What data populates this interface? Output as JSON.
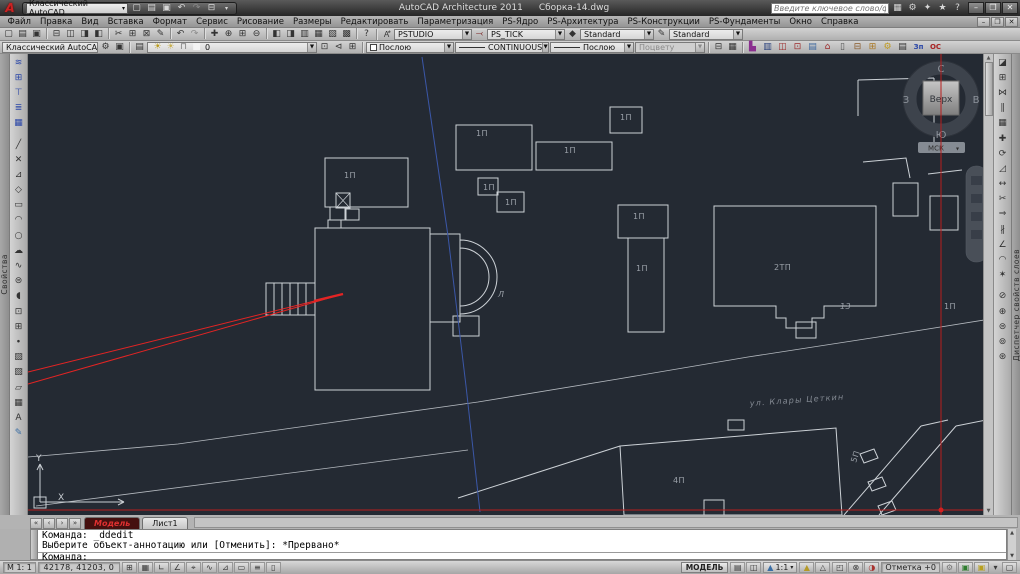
{
  "window": {
    "app_title": "AutoCAD Architecture 2011",
    "doc_title": "Сборка-14.dwg",
    "workspace": "Классический AutoCAD",
    "search_placeholder": "Введите ключевое слово/фразу",
    "minimize": "–",
    "restore": "❐",
    "close": "✕"
  },
  "menu": {
    "items": [
      "Файл",
      "Правка",
      "Вид",
      "Вставка",
      "Формат",
      "Сервис",
      "Рисование",
      "Размеры",
      "Редактировать",
      "Параметризация",
      "PS-Ядро",
      "PS-Архитектура",
      "PS-Конструкции",
      "PS-Фундаменты",
      "Окно",
      "Справка"
    ]
  },
  "toolbar1": {
    "icons": [
      {
        "n": "new-file-icon",
        "g": "▢"
      },
      {
        "n": "open-file-icon",
        "g": "▤"
      },
      {
        "n": "save-icon",
        "g": "▣"
      },
      {
        "n": "sep",
        "g": ""
      },
      {
        "n": "plot-icon",
        "g": "⊟"
      },
      {
        "n": "plot-preview-icon",
        "g": "◫"
      },
      {
        "n": "publish-icon",
        "g": "◨"
      },
      {
        "n": "3ddwf-icon",
        "g": "◧"
      },
      {
        "n": "sep",
        "g": ""
      },
      {
        "n": "cut-icon",
        "g": "✂"
      },
      {
        "n": "copy-clip-icon",
        "g": "⊞"
      },
      {
        "n": "paste-icon",
        "g": "⊠"
      },
      {
        "n": "match-properties-icon",
        "g": "✎"
      },
      {
        "n": "sep",
        "g": ""
      },
      {
        "n": "undo-icon",
        "g": "↶"
      },
      {
        "n": "redo-icon",
        "g": "↷",
        "c": "#8a8a8a"
      },
      {
        "n": "sep",
        "g": ""
      },
      {
        "n": "pan-icon",
        "g": "✚"
      },
      {
        "n": "zoom-realtime-icon",
        "g": "⊕"
      },
      {
        "n": "zoom-window-icon",
        "g": "⊞"
      },
      {
        "n": "zoom-previous-icon",
        "g": "⊖"
      },
      {
        "n": "sep",
        "g": ""
      },
      {
        "n": "properties-icon",
        "g": "◧"
      },
      {
        "n": "designcenter-icon",
        "g": "◨"
      },
      {
        "n": "tool-palettes-icon",
        "g": "▥"
      },
      {
        "n": "sheetset-icon",
        "g": "▦"
      },
      {
        "n": "markup-icon",
        "g": "▧"
      },
      {
        "n": "quickcalc-icon",
        "g": "▩"
      },
      {
        "n": "sep",
        "g": ""
      },
      {
        "n": "help-icon",
        "g": "?"
      }
    ],
    "style_combo1": "PSTUDIO",
    "style_combo2": "PS_TICK",
    "text_style": "Standard",
    "dim_style": "Standard"
  },
  "toolbar2": {
    "workspace": "Классический AutoCAD",
    "workspace_icons": [
      {
        "n": "workspace-settings-icon",
        "g": "⚙"
      },
      {
        "n": "workspace-save-icon",
        "g": "▣"
      }
    ],
    "layer_icons": [
      {
        "n": "layer-properties-icon",
        "g": "▤"
      }
    ],
    "layer_state_icons": [
      {
        "n": "layer-bulb-icon",
        "g": "☀",
        "c": "#b99a1c"
      },
      {
        "n": "layer-freeze-icon",
        "g": "☀",
        "c": "#c8b050"
      },
      {
        "n": "layer-lock-icon",
        "g": "⊓",
        "c": "#777"
      },
      {
        "n": "layer-color-icon",
        "g": "■",
        "c": "#f4f4f4"
      }
    ],
    "layer": "0",
    "layer_tools": [
      {
        "n": "make-layer-current-icon",
        "g": "⊡"
      },
      {
        "n": "layer-previous-icon",
        "g": "⊲"
      },
      {
        "n": "layer-states-icon",
        "g": "⊞"
      }
    ],
    "color": "Послою",
    "linetype": "CONTINUOUS",
    "lineweight": "Послою",
    "plotstyle": "Поцвету",
    "mid_icons": [
      {
        "n": "plot-style-icon",
        "g": "⊟"
      },
      {
        "n": "table-style-icon",
        "g": "▦"
      }
    ],
    "ps_icons": [
      {
        "n": "ps-wall-icon",
        "g": "▙",
        "c": "#8a2f8f"
      },
      {
        "n": "ps-block-icon",
        "g": "▥",
        "c": "#29417d"
      },
      {
        "n": "ps-door-icon",
        "g": "◫",
        "c": "#9c2b2b"
      },
      {
        "n": "ps-window-icon",
        "g": "⊡",
        "c": "#9c2b2b"
      },
      {
        "n": "ps-stair-icon",
        "g": "▤",
        "c": "#3f69a0"
      },
      {
        "n": "ps-roof-icon",
        "g": "⌂",
        "c": "#9c2b2b"
      },
      {
        "n": "ps-column-icon",
        "g": "▯",
        "c": "#555"
      },
      {
        "n": "ps-beam-icon",
        "g": "⊟",
        "c": "#8a5a2a"
      },
      {
        "n": "ps-grid-icon",
        "g": "⊞",
        "c": "#aa7722"
      },
      {
        "n": "ps-settings-icon",
        "g": "⚙",
        "c": "#c09a1e"
      },
      {
        "n": "ps-dark-icon",
        "g": "▤",
        "c": "#333"
      },
      {
        "n": "ps-zp-button",
        "g": "Зп",
        "c": "#2b47a8",
        "text": true
      },
      {
        "n": "ps-os-button",
        "g": "ОС",
        "c": "#a82222",
        "text": true
      }
    ]
  },
  "panels": {
    "left_tab": "Свойства",
    "right_tab": "Диспетчер свойств слоев"
  },
  "left_toolbar": {
    "icons": [
      {
        "n": "ps-axis-icon",
        "g": "≋",
        "c": "#2b47a8"
      },
      {
        "n": "ps-level-icon",
        "g": "⊞",
        "c": "#2b47a8"
      },
      {
        "n": "ps-section-icon",
        "g": "⊤",
        "c": "#2b47a8"
      },
      {
        "n": "ps-mark-icon",
        "g": "≣",
        "c": "#2b47a8"
      },
      {
        "n": "ps-table-icon",
        "g": "▦",
        "c": "#2b47a8"
      },
      {
        "n": "sep",
        "g": ""
      },
      {
        "n": "line-icon",
        "g": "╱"
      },
      {
        "n": "construction-line-icon",
        "g": "✕"
      },
      {
        "n": "polyline-icon",
        "g": "⊿"
      },
      {
        "n": "polygon-icon",
        "g": "◇"
      },
      {
        "n": "rectangle-icon",
        "g": "▭"
      },
      {
        "n": "arc-icon",
        "g": "◠"
      },
      {
        "n": "circle-icon",
        "g": "○"
      },
      {
        "n": "revision-cloud-icon",
        "g": "☁"
      },
      {
        "n": "spline-icon",
        "g": "∿"
      },
      {
        "n": "ellipse-icon",
        "g": "⊜"
      },
      {
        "n": "ellipse-arc-icon",
        "g": "◖"
      },
      {
        "n": "insert-block-icon",
        "g": "⊡"
      },
      {
        "n": "make-block-icon",
        "g": "⊞"
      },
      {
        "n": "point-icon",
        "g": "∙"
      },
      {
        "n": "hatch-icon",
        "g": "▨"
      },
      {
        "n": "gradient-icon",
        "g": "▧"
      },
      {
        "n": "region-icon",
        "g": "▱"
      },
      {
        "n": "table-icon",
        "g": "▦"
      },
      {
        "n": "mtext-icon",
        "g": "A"
      },
      {
        "n": "addselected-icon",
        "g": "✎",
        "c": "#3a6ea5"
      }
    ]
  },
  "right_toolbar": {
    "icons": [
      {
        "n": "erase-icon",
        "g": "◪"
      },
      {
        "n": "copy-icon",
        "g": "⊞"
      },
      {
        "n": "mirror-icon",
        "g": "⋈"
      },
      {
        "n": "offset-icon",
        "g": "∥"
      },
      {
        "n": "array-icon",
        "g": "▦"
      },
      {
        "n": "move-icon",
        "g": "✚"
      },
      {
        "n": "rotate-icon",
        "g": "⟳"
      },
      {
        "n": "scale-icon",
        "g": "◿"
      },
      {
        "n": "stretch-icon",
        "g": "↔"
      },
      {
        "n": "trim-icon",
        "g": "✂"
      },
      {
        "n": "extend-icon",
        "g": "⇒"
      },
      {
        "n": "break-icon",
        "g": "∦"
      },
      {
        "n": "chamfer-icon",
        "g": "∠"
      },
      {
        "n": "fillet-icon",
        "g": "◠"
      },
      {
        "n": "explode-icon",
        "g": "✶"
      },
      {
        "n": "sep",
        "g": ""
      },
      {
        "n": "layer-off-icon",
        "g": "⊘"
      },
      {
        "n": "layer-isolate-icon",
        "g": "⊕"
      },
      {
        "n": "layer-freeze2-icon",
        "g": "⊜"
      },
      {
        "n": "layer-lock2-icon",
        "g": "⊚"
      },
      {
        "n": "layer-match-icon",
        "g": "⊛"
      }
    ]
  },
  "viewcube": {
    "north": "С",
    "south": "Ю",
    "west": "З",
    "east": "В",
    "top": "Верх",
    "menu": "МСК"
  },
  "drawing": {
    "street_label": "ул. Клары Цеткин",
    "labels": [
      {
        "t": "1П",
        "x": 316,
        "y": 124
      },
      {
        "t": "1П",
        "x": 448,
        "y": 82
      },
      {
        "t": "1П",
        "x": 536,
        "y": 99
      },
      {
        "t": "1П",
        "x": 455,
        "y": 136
      },
      {
        "t": "1П",
        "x": 477,
        "y": 151
      },
      {
        "t": "1П",
        "x": 592,
        "y": 66
      },
      {
        "t": "1П",
        "x": 605,
        "y": 165
      },
      {
        "t": "1П",
        "x": 608,
        "y": 217
      },
      {
        "t": "2ТП",
        "x": 746,
        "y": 216
      },
      {
        "t": "13",
        "x": 812,
        "y": 255,
        "i": true
      },
      {
        "t": "1П",
        "x": 916,
        "y": 255
      },
      {
        "t": "Л",
        "x": 470,
        "y": 243,
        "i": true
      },
      {
        "t": "4П",
        "x": 645,
        "y": 429
      },
      {
        "t": "5П",
        "x": 828,
        "y": 409,
        "rot": -72
      },
      {
        "t": "Y",
        "x": 8,
        "y": 407,
        "cls": "axis"
      },
      {
        "t": "X",
        "x": 30,
        "y": 446,
        "cls": "axis"
      }
    ]
  },
  "tabs": {
    "model": "Модель",
    "layout1": "Лист1"
  },
  "command": {
    "line1": "Команда: _ddedit",
    "line2": "Выберите объект-аннотацию или [Отменить]: *Прервано*",
    "prompt": "Команда:"
  },
  "status": {
    "scale_left": "М 1: 1",
    "coords": "42178, 41203, 0",
    "toggles": [
      {
        "n": "snap-toggle",
        "g": "⊞"
      },
      {
        "n": "grid-toggle",
        "g": "▦"
      },
      {
        "n": "ortho-toggle",
        "g": "∟"
      },
      {
        "n": "polar-toggle",
        "g": "∠"
      },
      {
        "n": "osnap-toggle",
        "g": "⌖"
      },
      {
        "n": "otrack-toggle",
        "g": "∿"
      },
      {
        "n": "ducs-toggle",
        "g": "⊿"
      },
      {
        "n": "dyn-toggle",
        "g": "▭"
      },
      {
        "n": "lwt-toggle",
        "g": "≡"
      },
      {
        "n": "qp-toggle",
        "g": "▯"
      }
    ],
    "model_button": "МОДЕЛЬ",
    "right_icons1": [
      {
        "n": "model-space-icon",
        "g": "▤"
      },
      {
        "n": "layout-icon",
        "g": "◫"
      }
    ],
    "annot_scale": "1:1",
    "right_icons2": [
      {
        "n": "annotation-visibility-icon",
        "g": "▲",
        "c": "#b59a28"
      },
      {
        "n": "annotation-autoscale-icon",
        "g": "△"
      }
    ],
    "right_icons3": [
      {
        "n": "quickview-drawings-icon",
        "g": "◰"
      },
      {
        "n": "navigation-lock-icon",
        "g": "⊗"
      },
      {
        "n": "isolate-objects-icon",
        "g": "◑",
        "c": "#a8332f"
      }
    ],
    "elevation": "Отметка  +0",
    "right_icons4": [
      {
        "n": "workspace-switch-icon",
        "g": "⚙",
        "c": "#777"
      },
      {
        "n": "tray-plot-icon",
        "g": "▣",
        "c": "#2f7d2f"
      },
      {
        "n": "tray-bulb-icon",
        "g": "▣",
        "c": "#b8a020"
      }
    ],
    "tray_arrow": "▾",
    "clean_screen": "▢"
  }
}
